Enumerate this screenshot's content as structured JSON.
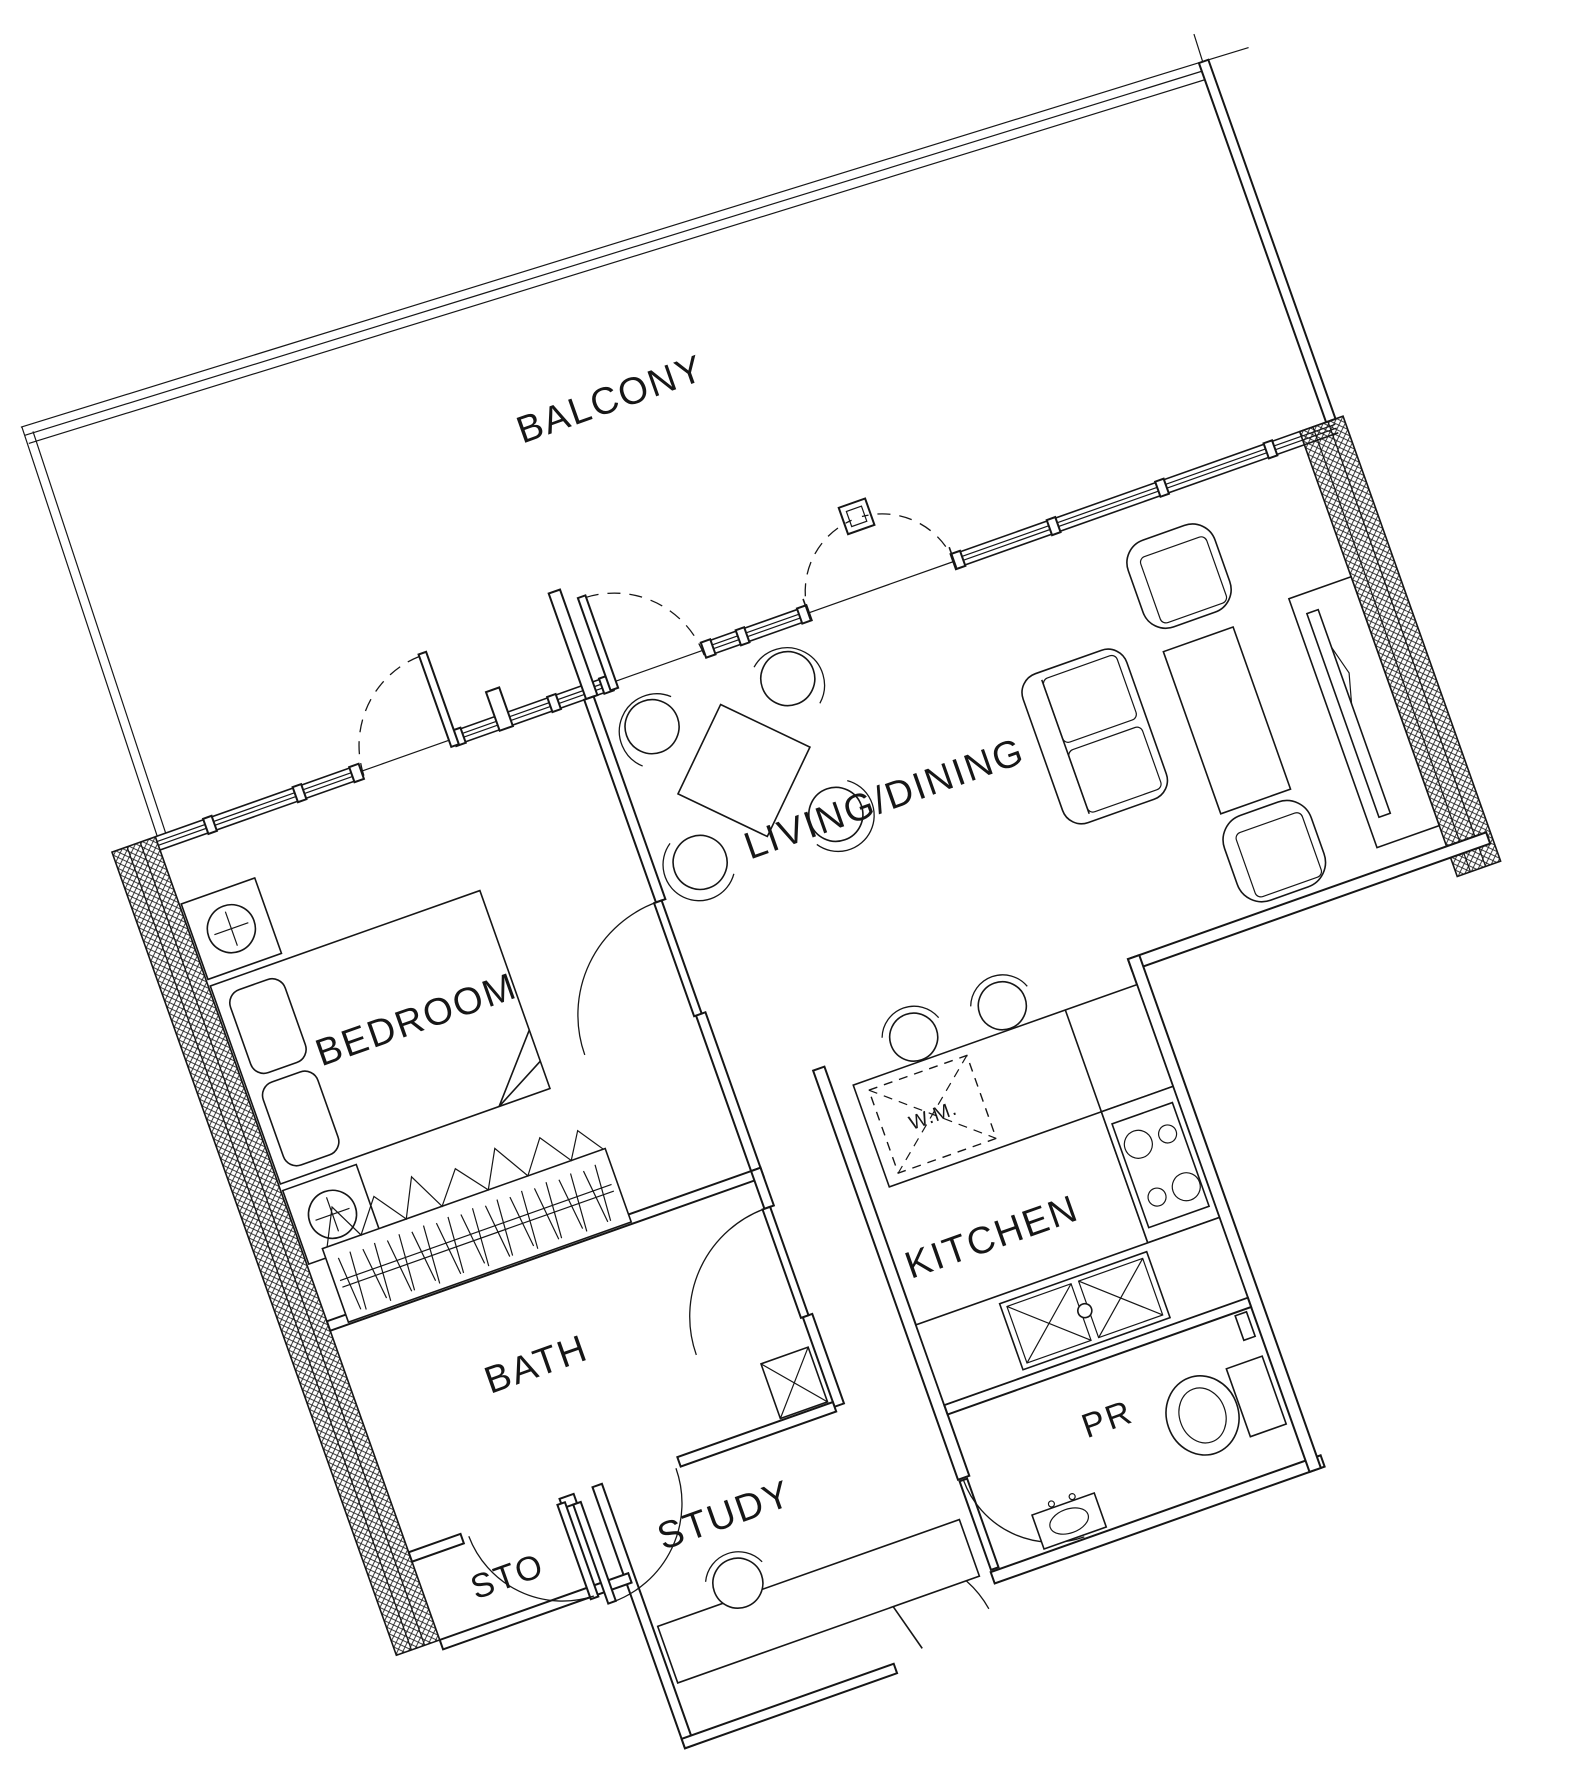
{
  "document": {
    "type": "architectural-floor-plan",
    "background_color": "#ffffff",
    "line_color": "#161616",
    "rotation_deg": -19.5
  },
  "rooms": [
    {
      "id": "balcony",
      "label": "BALCONY"
    },
    {
      "id": "living-dining",
      "label": "LIVING/DINING"
    },
    {
      "id": "bedroom",
      "label": "BEDROOM"
    },
    {
      "id": "kitchen",
      "label": "KITCHEN"
    },
    {
      "id": "bath",
      "label": "BATH"
    },
    {
      "id": "study",
      "label": "STUDY"
    },
    {
      "id": "storage",
      "label": "STO"
    },
    {
      "id": "powder-room",
      "label": "PR"
    }
  ],
  "appliances": {
    "washing_machine_label": "W.M."
  }
}
